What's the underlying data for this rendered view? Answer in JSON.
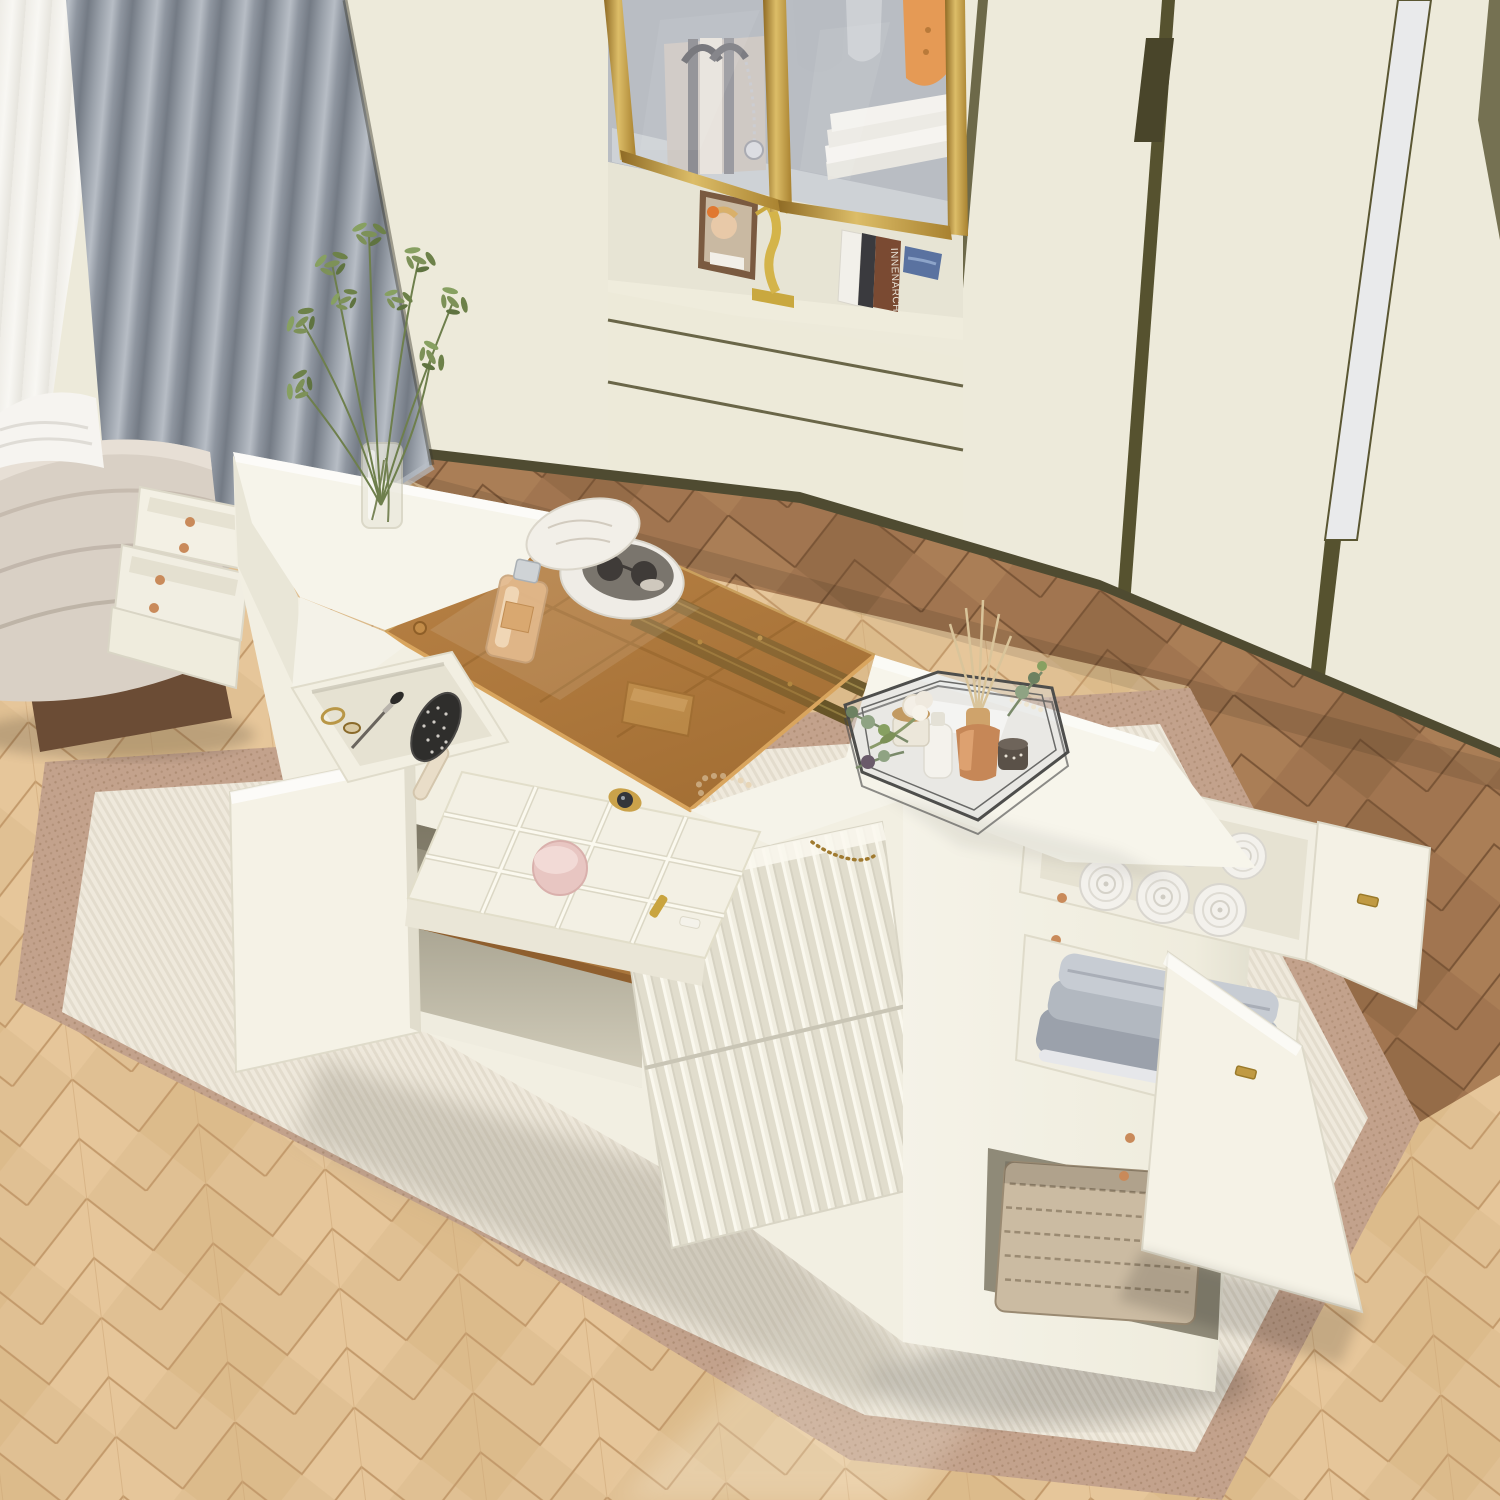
{
  "scene": {
    "domain": "natural-image",
    "description": "Angled top-down product photo of a cream storage island dresser with pull-out drawers, flip-open amber tempered glass top, jewelry organizer and open cabinets, staged in a dressing room with cream wardrobes, a gold-framed glass display cabinet, gray curtains, a beige channel-tufted bench, herringbone wood flooring and a bordered area rug.",
    "book_spine_text": "INNENARCH",
    "palette": {
      "wall_cream": "#EDEADA",
      "trim_dark_olive": "#56522F",
      "gold_frame": "#C9A24F",
      "curtain_gray": "#98A0A8",
      "sheer_white": "#F5F4F0",
      "oak_floor": "#DFBE92",
      "walnut_floor": "#9A744E",
      "rug_border_tan": "#C3A28C",
      "rug_field_cream": "#EFE9DD",
      "island_white": "#F5F3EA",
      "amber_glass": "#B5803F",
      "towel_gray": "#A9AEB7",
      "rattan": "#C08A4C",
      "copper_screw": "#C98A5A",
      "greenery": "#7C8F5E",
      "gold_handle": "#C09A43",
      "ottoman_beige": "#D9D0C5"
    },
    "objects": [
      "sheer-curtain",
      "gray-curtain",
      "upholstered-bench",
      "white-throw",
      "wardrobe-wall",
      "gold-glass-display-cabinet",
      "tote-bag",
      "hanging-clothes",
      "folded-towels",
      "photo-frame",
      "gold-figurine",
      "books",
      "denim-stack",
      "storage-island",
      "amber-glass-top",
      "drawer-slide-rails",
      "jewelry-organizer",
      "hair-brush",
      "makeup-brush",
      "perfume-bottle",
      "round-jewelry-box",
      "sunglasses",
      "pearl-necklace",
      "gold-chain",
      "white-rose",
      "mirror-hexagon-tray",
      "reed-diffuser",
      "lotion-bottle",
      "cream-jar",
      "eucalyptus-sprigs",
      "pearl-strand",
      "towel-rolls",
      "gray-folded-towels",
      "rattan-basket",
      "woven-basket",
      "fluted-drawer-fronts",
      "open-cabinet-door",
      "pull-out-side-drawers",
      "area-rug",
      "herringbone-floor",
      "glass-vase",
      "green-plant"
    ]
  }
}
